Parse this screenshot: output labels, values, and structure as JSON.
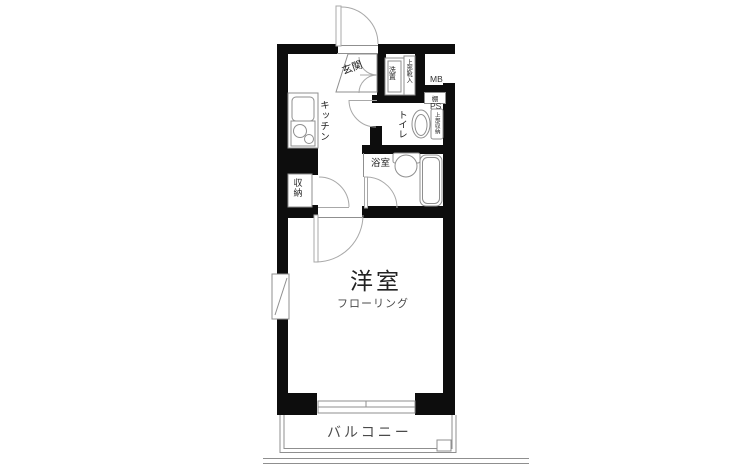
{
  "floorplan": {
    "rooms": {
      "entrance": "玄関",
      "kitchen": "キッチン",
      "toilet": "トイレ",
      "bathroom": "浴室",
      "closet": "収納",
      "main_room": "洋室",
      "main_room_sub": "フローリング",
      "balcony": "バルコニー"
    },
    "fixtures": {
      "washer": "洗置",
      "shoe_upper": "上部靴入",
      "shelf": "棚",
      "toilet_upper": "上部収納",
      "mb": "MB",
      "ps": "PS"
    },
    "colors": {
      "wall": "#0d0d0d",
      "fixture_line": "#8f8f8f",
      "door_line": "#a8a8a8",
      "text": "#222222",
      "subtext": "#4a4a4a",
      "background": "#ffffff"
    }
  }
}
